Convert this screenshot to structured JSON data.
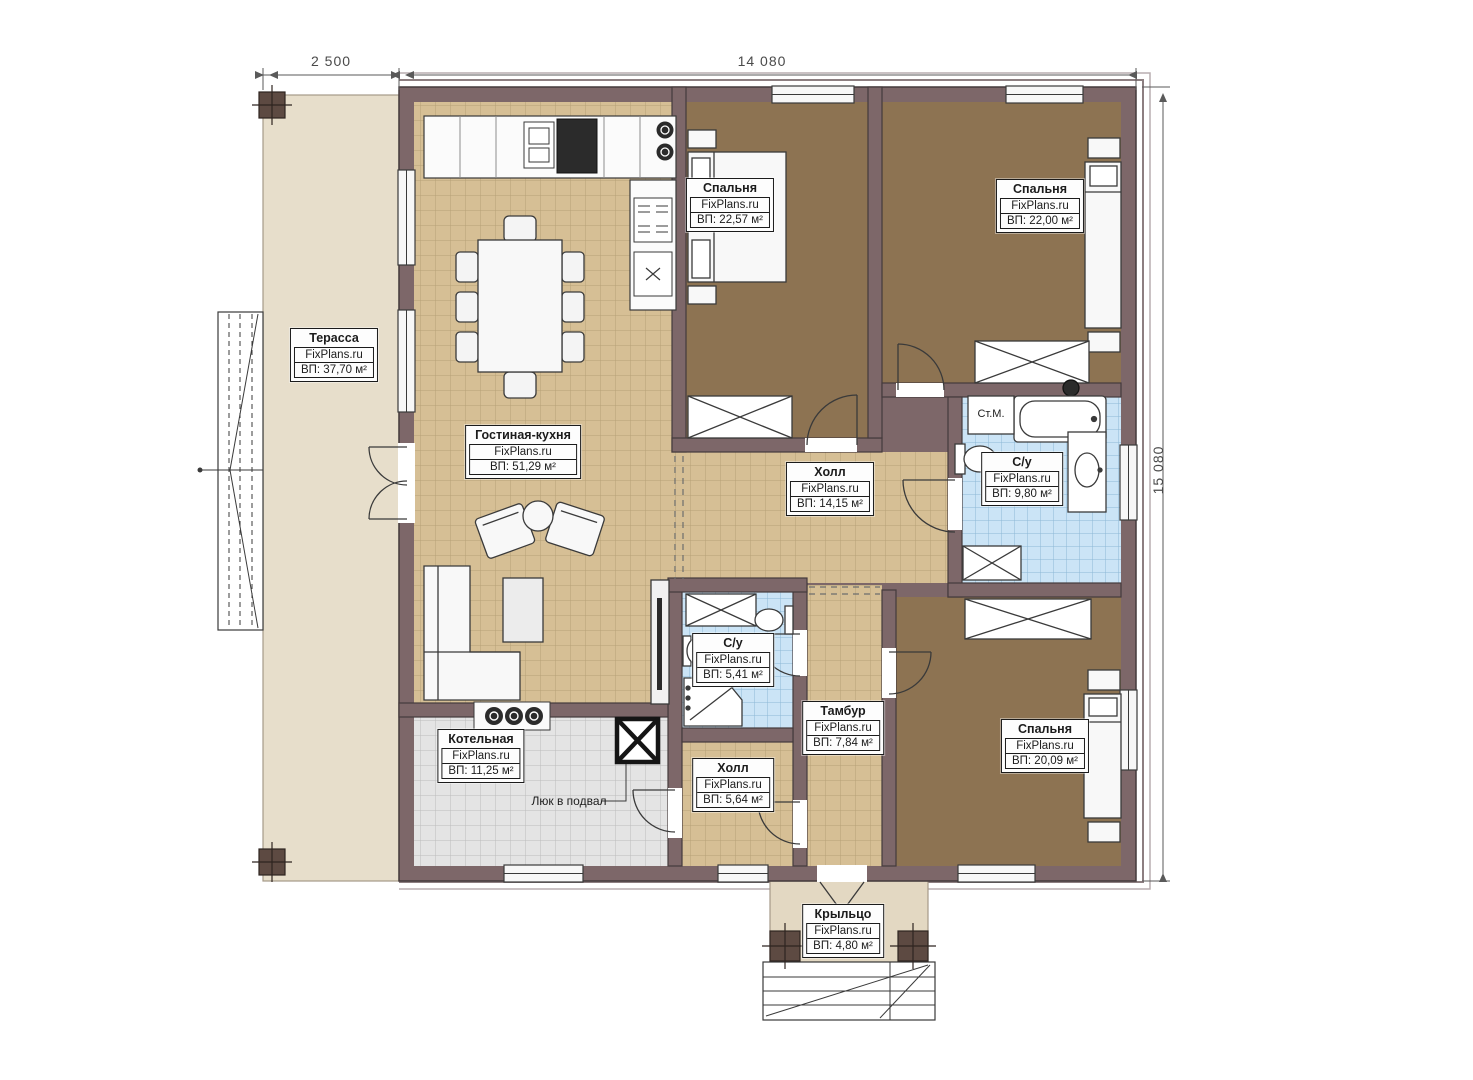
{
  "plan": {
    "title": "Одноэтажный дом — план этажа",
    "brand": "FixPlans.ru",
    "dimensions": {
      "terrace_width": "2 500",
      "house_width": "14 080",
      "house_height": "15 080"
    },
    "annotations": {
      "basement_hatch": "Люк в подвал",
      "washing_machine": "Ст.М."
    },
    "rooms": [
      {
        "id": "terrace",
        "name": "Терасса",
        "area": "ВП: 37,70 м²"
      },
      {
        "id": "living-kitchen",
        "name": "Гостиная-кухня",
        "area": "ВП: 51,29 м²"
      },
      {
        "id": "bedroom-1",
        "name": "Спальня",
        "area": "ВП: 22,57 м²"
      },
      {
        "id": "bedroom-2",
        "name": "Спальня",
        "area": "ВП: 22,00 м²"
      },
      {
        "id": "hall-main",
        "name": "Холл",
        "area": "ВП: 14,15 м²"
      },
      {
        "id": "bathroom-main",
        "name": "С/у",
        "area": "ВП: 9,80 м²"
      },
      {
        "id": "bathroom-small",
        "name": "С/у",
        "area": "ВП: 5,41 м²"
      },
      {
        "id": "tambour",
        "name": "Тамбур",
        "area": "ВП: 7,84 м²"
      },
      {
        "id": "hall-small",
        "name": "Холл",
        "area": "ВП: 5,64 м²"
      },
      {
        "id": "boiler-room",
        "name": "Котельная",
        "area": "ВП: 11,25 м²"
      },
      {
        "id": "bedroom-3",
        "name": "Спальня",
        "area": "ВП: 20,09 м²"
      },
      {
        "id": "porch",
        "name": "Крыльцо",
        "area": "ВП: 4,80 м²"
      }
    ],
    "colors": {
      "wall": "#7d6769",
      "floor_living": "#d6bf95",
      "floor_bedroom": "#8d7352",
      "floor_bath": "#cbe4f6",
      "floor_boiler": "#e4e4e4",
      "floor_terrace": "#e7decb",
      "floor_porch": "#e3d8c2"
    }
  }
}
